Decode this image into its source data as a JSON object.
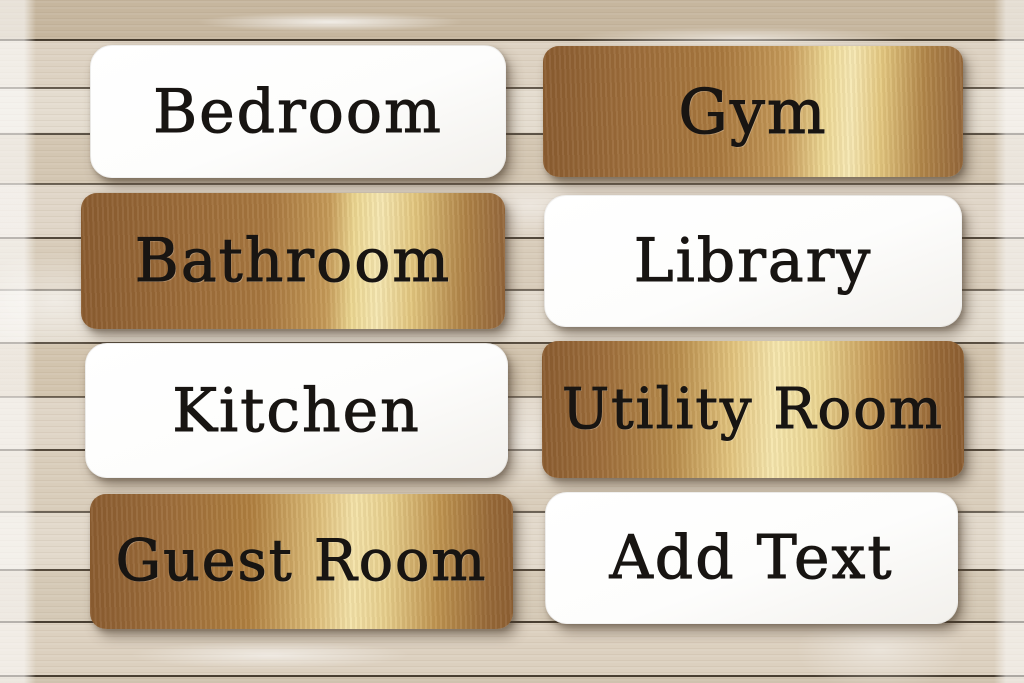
{
  "photo": {
    "subject": "Room door sign plates displayed on weathered whitewashed wood planks"
  },
  "signs": [
    {
      "label": "Bedroom",
      "finish": "white"
    },
    {
      "label": "Gym",
      "finish": "gold"
    },
    {
      "label": "Bathroom",
      "finish": "gold"
    },
    {
      "label": "Library",
      "finish": "white"
    },
    {
      "label": "Kitchen",
      "finish": "white"
    },
    {
      "label": "Utility Room",
      "finish": "gold"
    },
    {
      "label": "Guest Room",
      "finish": "gold"
    },
    {
      "label": "Add Text",
      "finish": "white"
    }
  ],
  "colors": {
    "gold_base": "#9c6c3a",
    "gold_highlight": "#f6e8b2",
    "sign_white": "#fefefe",
    "engraved_text": "#181512",
    "wood_light": "#e2d9cb",
    "wood_dark": "#c6b69e",
    "plank_seam": "#30261a"
  }
}
